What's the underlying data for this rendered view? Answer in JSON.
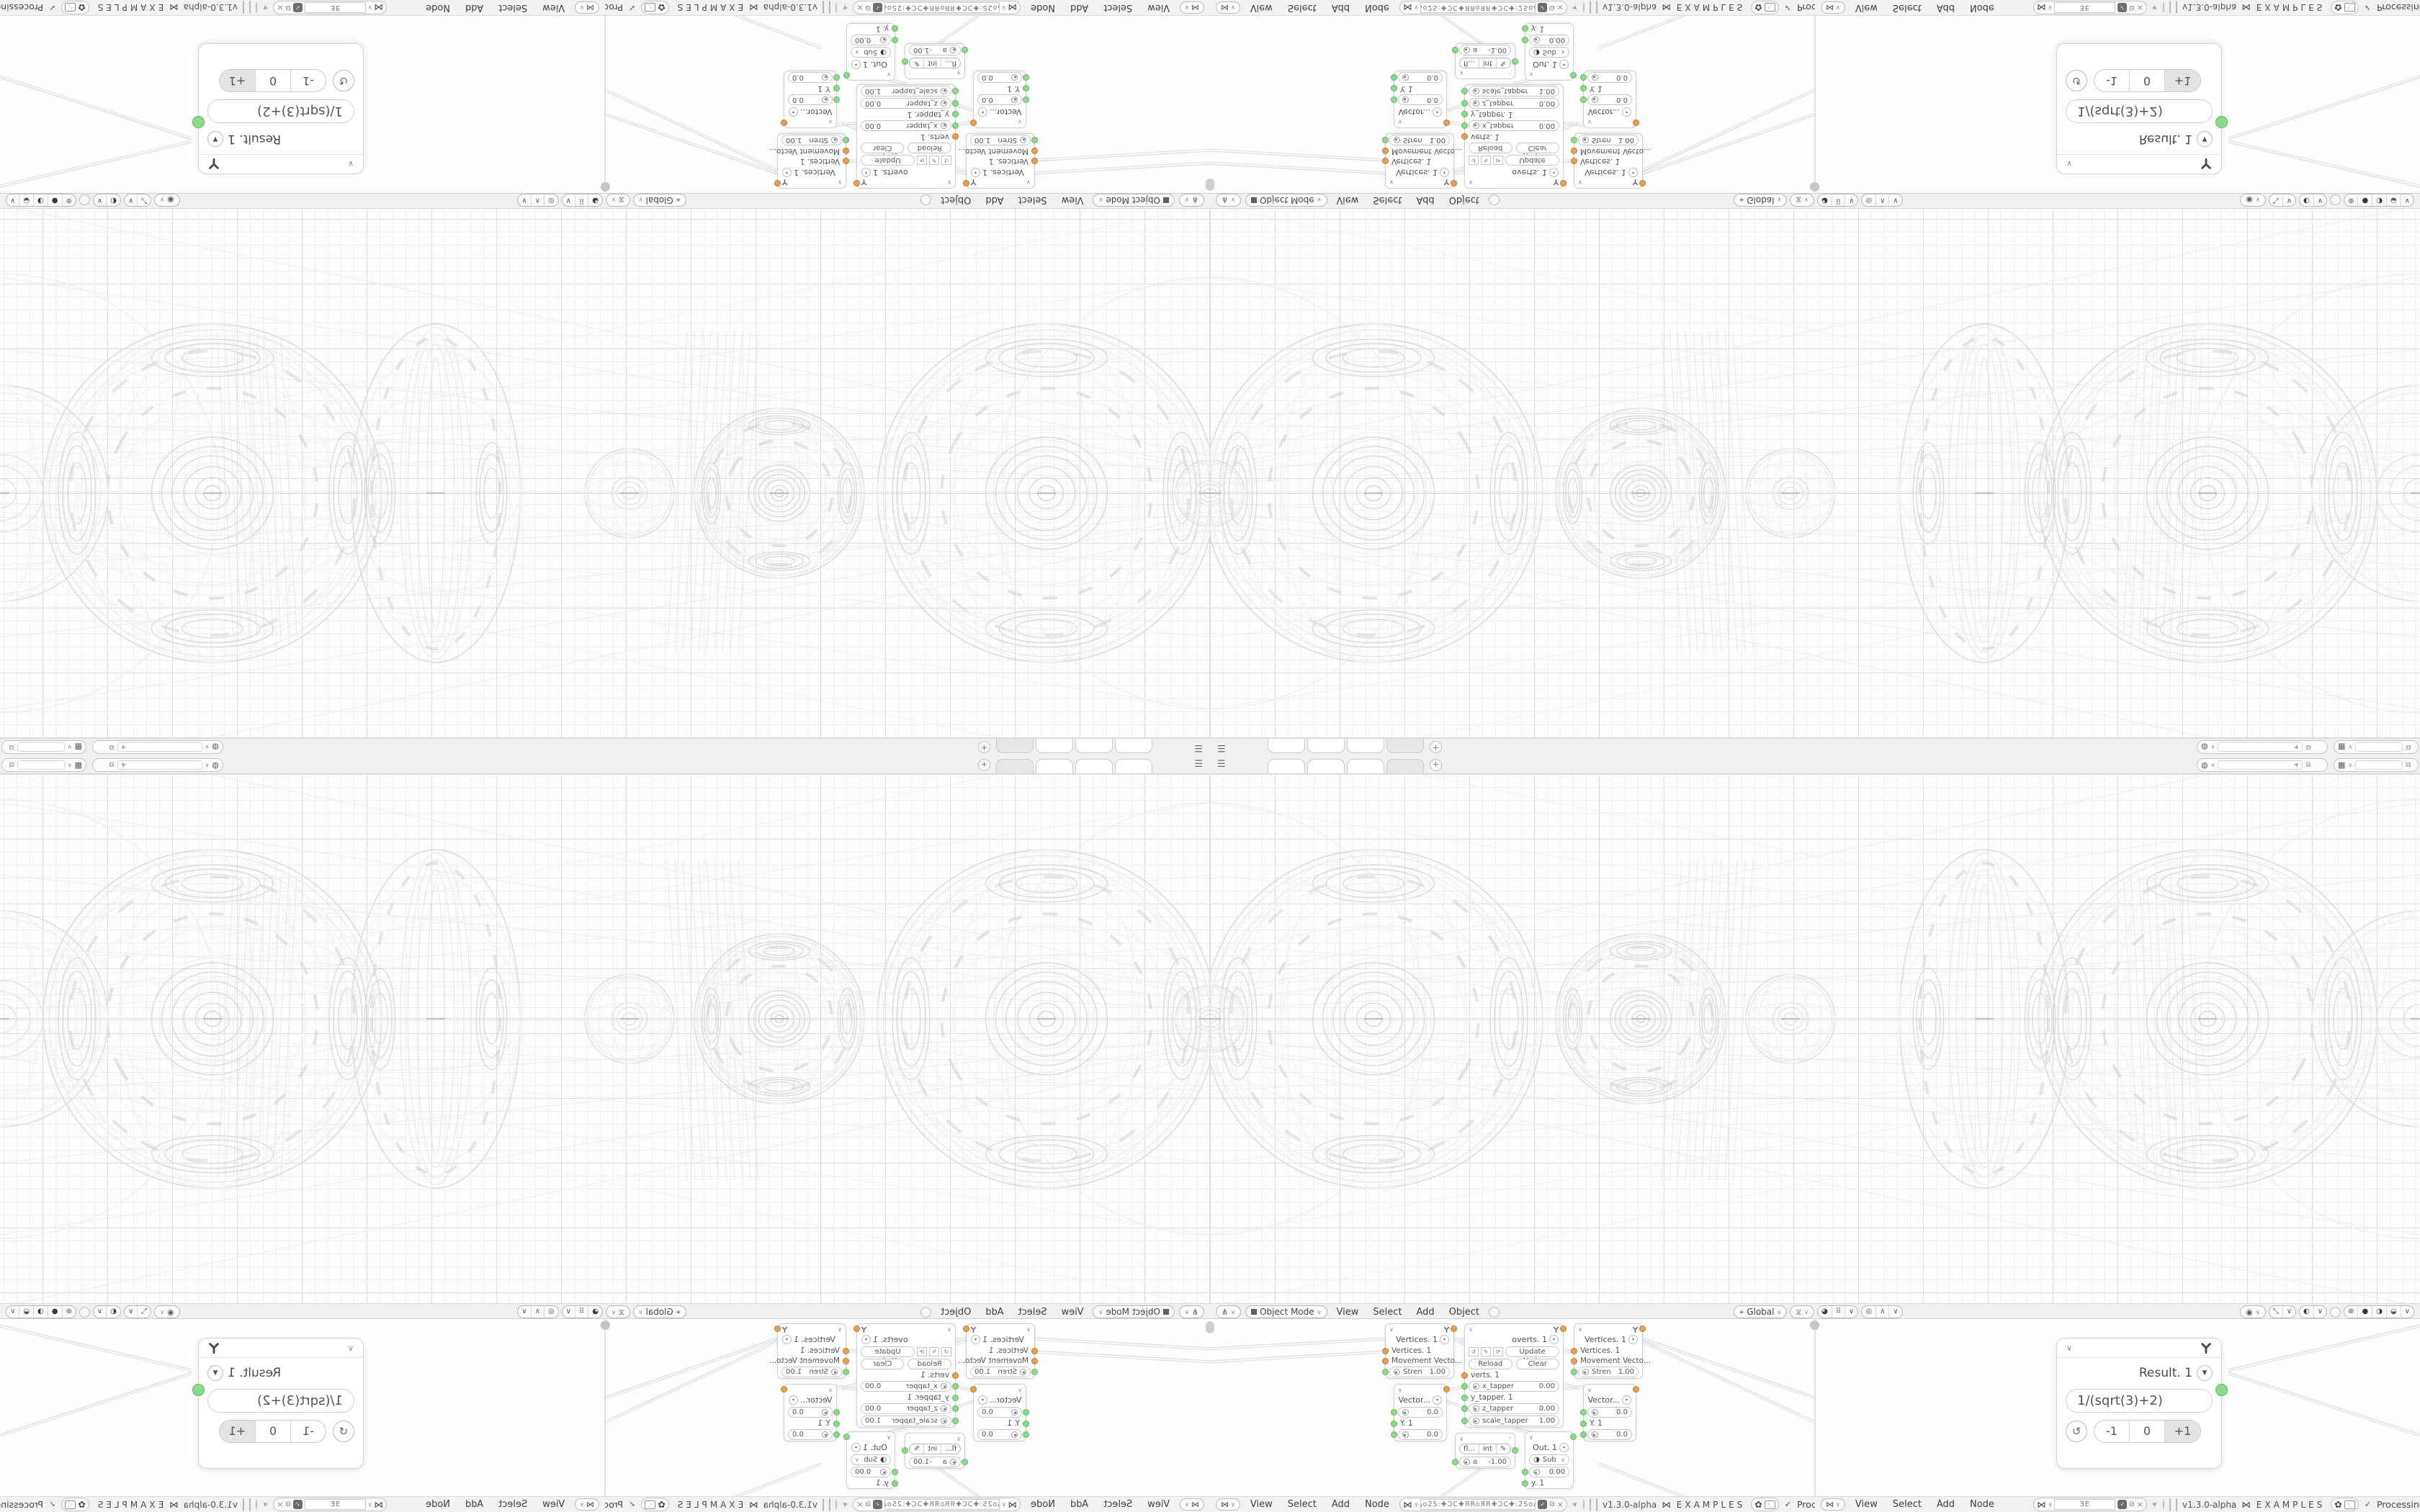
{
  "strip": {
    "add_tab_label": "+"
  },
  "viewport_header": {
    "mode_label": "Object Mode",
    "menu_view": "View",
    "menu_select": "Select",
    "menu_add": "Add",
    "menu_object": "Object",
    "orientation_label": "Global"
  },
  "nodebar": {
    "menu_view": "View",
    "menu_select": "Select",
    "menu_add": "Add",
    "menu_node": "Node",
    "filter_1": "oΔo2S:✚ƆC✚ЯRoЯR✚ƆC✚:2SoΔo",
    "filter_2": "ƎE",
    "version": "v1.3.0-alpha",
    "brand": "EXAMPLES",
    "status": "Processing"
  },
  "result": {
    "title": "Result. 1",
    "expression": "1/(sqrt(3)+2)",
    "btn_minus": "-1",
    "btn_zero": "0",
    "btn_plus": "+1"
  },
  "nodes": {
    "vertices": {
      "title": "Vertices. 1",
      "row1": "Vertices. 1",
      "row2": "Movement Vecto...",
      "field_label": "Stren",
      "field_value": "1.00"
    },
    "vector": {
      "title": "Vector...",
      "f1": "0.0",
      "row": "Y. 1",
      "f2": "0.0"
    },
    "overts": {
      "title": "overts. 1",
      "update_label": "Update Node",
      "reload_label": "Reload",
      "clear_label": "Clear",
      "row1": "verts. 1",
      "f1_label": "x_tapper",
      "f1_value": "0.00",
      "row2": "y_tapper. 1",
      "f2_label": "z_tapper",
      "f2_value": "0.00",
      "f3_label": "scale_tapper",
      "f3_value": "1.00"
    },
    "mini": {
      "opt1": "fl...",
      "opt2": "int",
      "field_label": "a",
      "field_value": "-1.00"
    },
    "out": {
      "title": "Out. 1",
      "op": "Sub",
      "field_value": "0.00",
      "row": "y. 1"
    }
  },
  "colors": {
    "socket_green": "#8ed98e",
    "socket_orange": "#e6a254",
    "wire": "#dcdcdc",
    "grid_major": "#e0e0e0",
    "grid_minor": "#efefef"
  }
}
